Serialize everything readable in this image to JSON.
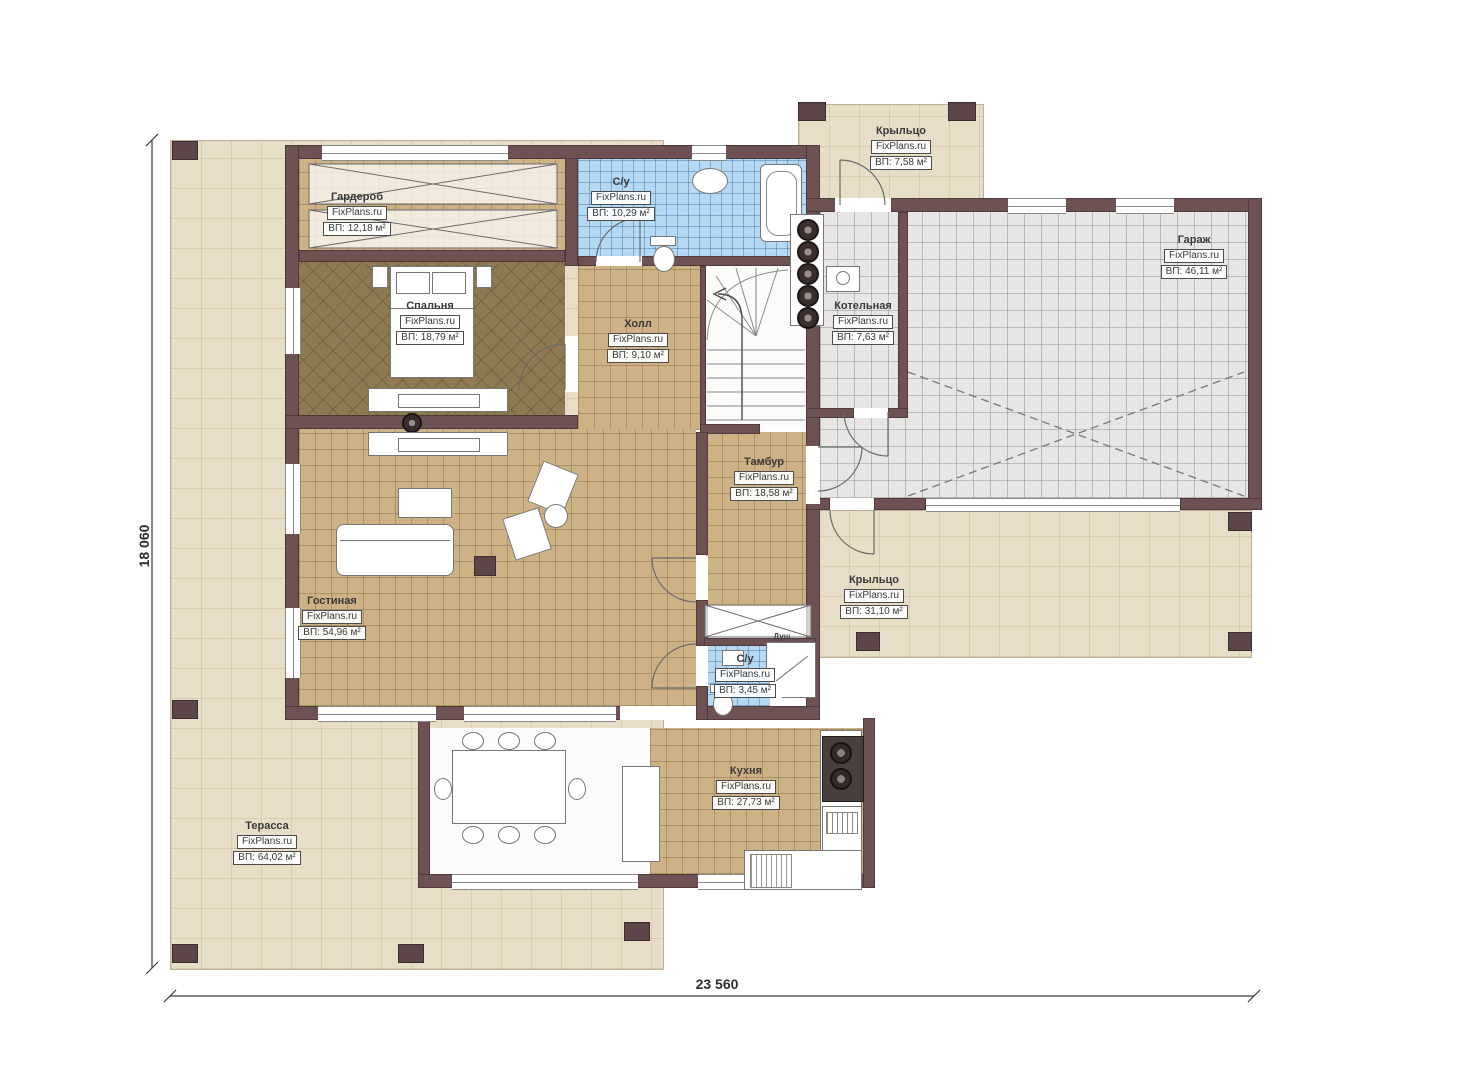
{
  "plan": {
    "brand": "FixPlans.ru",
    "rooms": [
      {
        "name": "Гардероб",
        "area": "ВП: 12,18 м²"
      },
      {
        "name": "Спальня",
        "area": "ВП: 18,79 м²"
      },
      {
        "name": "С/у",
        "area": "ВП: 10,29 м²"
      },
      {
        "name": "Крыльцо",
        "area": "ВП: 7,58 м²"
      },
      {
        "name": "Гараж",
        "area": "ВП: 46,11 м²"
      },
      {
        "name": "Котельная",
        "area": "ВП: 7,63 м²"
      },
      {
        "name": "Холл",
        "area": "ВП: 9,10 м²"
      },
      {
        "name": "Тамбур",
        "area": "ВП: 18,58 м²"
      },
      {
        "name": "Крыльцо",
        "area": "ВП: 31,10 м²"
      },
      {
        "name": "Гостиная",
        "area": "ВП: 54,96 м²"
      },
      {
        "name": "С/у",
        "area": "ВП: 3,45 м²"
      },
      {
        "name": "Кухня",
        "area": "ВП: 27,73 м²"
      },
      {
        "name": "Терасса",
        "area": "ВП: 64,02 м²"
      },
      {
        "name": "Душ",
        "area": ""
      }
    ],
    "dimensions": {
      "height_label": "18 060",
      "width_label": "23 560"
    },
    "colors": {
      "wall": "#6e5253",
      "floor_tan": "#cdb285",
      "floor_bedroom": "#8d7a52",
      "tile_blue": "#b5d8f3",
      "garage_gray": "#e7e6e4",
      "terrace_beige": "#e8ddc6"
    }
  }
}
